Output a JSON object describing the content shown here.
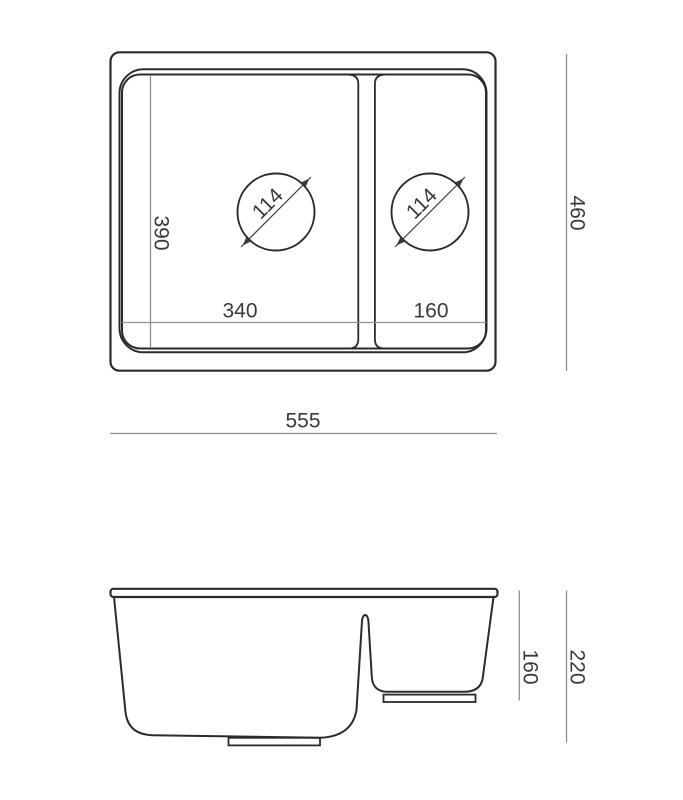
{
  "background_color": "#ffffff",
  "line_colors": {
    "outline": "#2b2b2b",
    "dimension_line": "#8f8f8f",
    "dimension_text": "#3a3a3a"
  },
  "top_view": {
    "overall_width": "555",
    "overall_depth": "460",
    "main_bowl_width": "340",
    "main_bowl_depth": "390",
    "half_bowl_width": "160",
    "main_bowl_drain_diameter": "114",
    "half_bowl_drain_diameter": "114"
  },
  "side_view": {
    "overall_height": "220",
    "half_bowl_height": "160"
  }
}
